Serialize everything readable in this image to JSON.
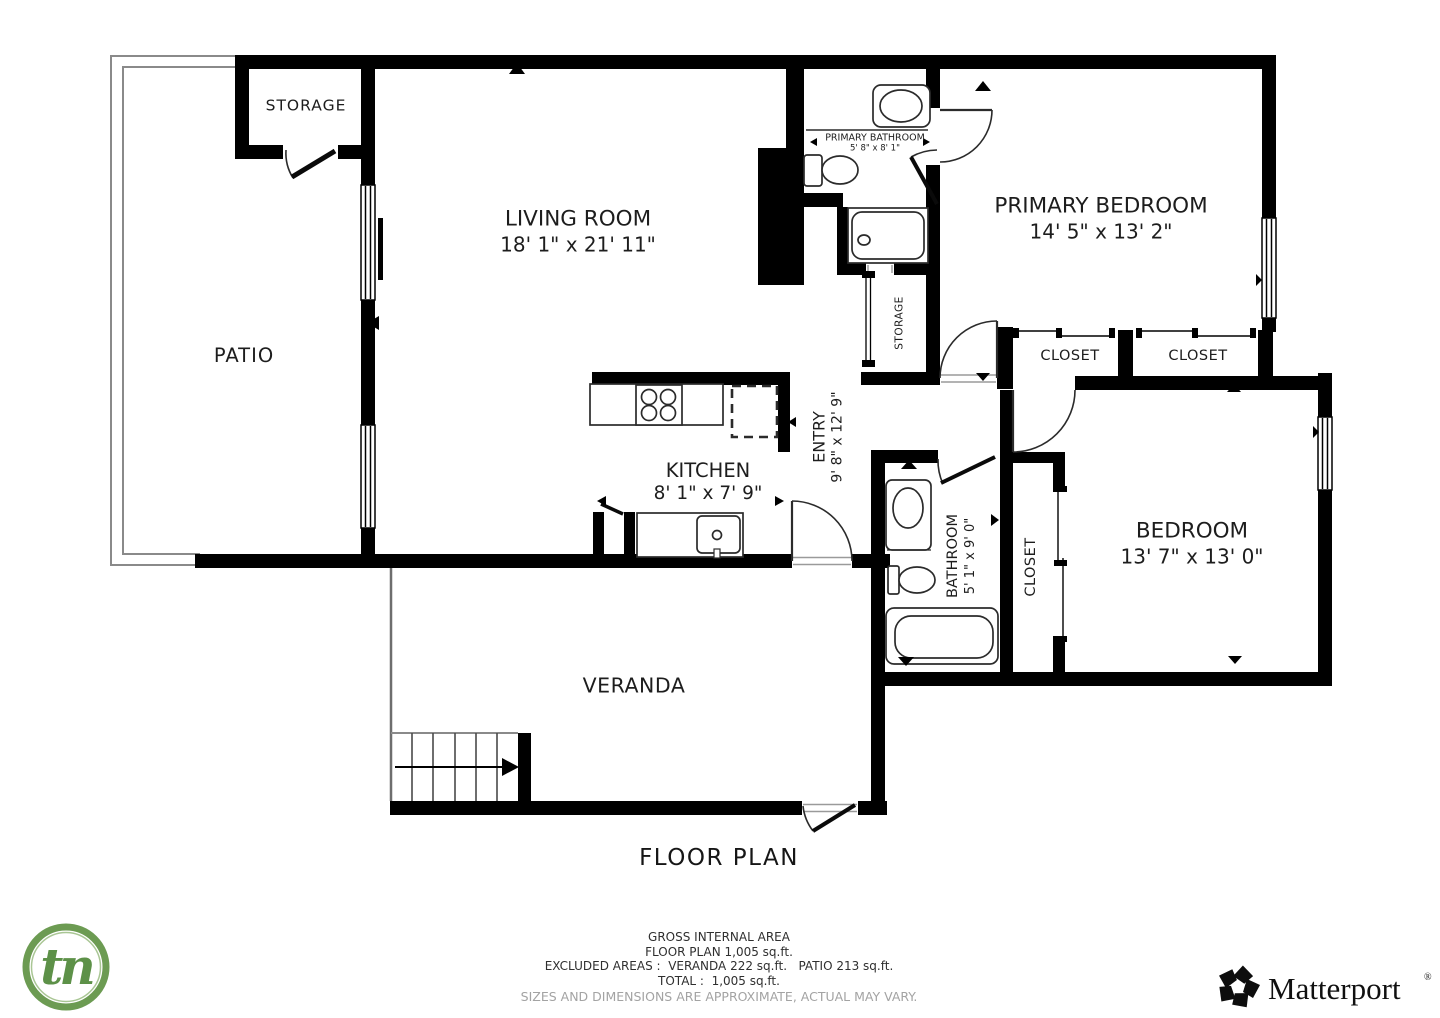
{
  "title": "FLOOR PLAN",
  "rooms": {
    "storage_top": "STORAGE",
    "living_room": "LIVING ROOM",
    "living_room_dims": "18' 1\" x 21' 11\"",
    "primary_bathroom": "PRIMARY BATHROOM",
    "primary_bathroom_dims": "5' 8\" x 8' 1\"",
    "primary_bedroom": "PRIMARY BEDROOM",
    "primary_bedroom_dims": "14' 5\" x 13' 2\"",
    "patio": "PATIO",
    "storage_mid": "STORAGE",
    "closet_primary_left": "CLOSET",
    "closet_primary_right": "CLOSET",
    "entry": "ENTRY",
    "entry_dims": "9' 8\" x 12' 9\"",
    "kitchen": "KITCHEN",
    "kitchen_dims": "8' 1\" x 7' 9\"",
    "bathroom": "BATHROOM",
    "bathroom_dims": "5' 1\" x 9' 0\"",
    "closet_bedroom": "CLOSET",
    "bedroom": "BEDROOM",
    "bedroom_dims": "13' 7\" x 13' 0\"",
    "veranda": "VERANDA"
  },
  "footer": {
    "line1": "GROSS INTERNAL AREA",
    "line2": "FLOOR PLAN 1,005 sq.ft.",
    "line3": "EXCLUDED AREAS :  VERANDA 222 sq.ft.   PATIO 213 sq.ft.",
    "line4": "TOTAL :  1,005 sq.ft.",
    "disclaimer": "SIZES AND DIMENSIONS ARE APPROXIMATE, ACTUAL MAY VARY."
  },
  "logos": {
    "tn_text": "tn",
    "matterport_text": "Matterport",
    "registered_mark": "®"
  },
  "colors": {
    "wall": "#000000",
    "thin_line": "#8a8a8a",
    "label": "#1d1d1d",
    "disclaimer": "#a3a3a3",
    "tn_green": "#6c9b52"
  }
}
